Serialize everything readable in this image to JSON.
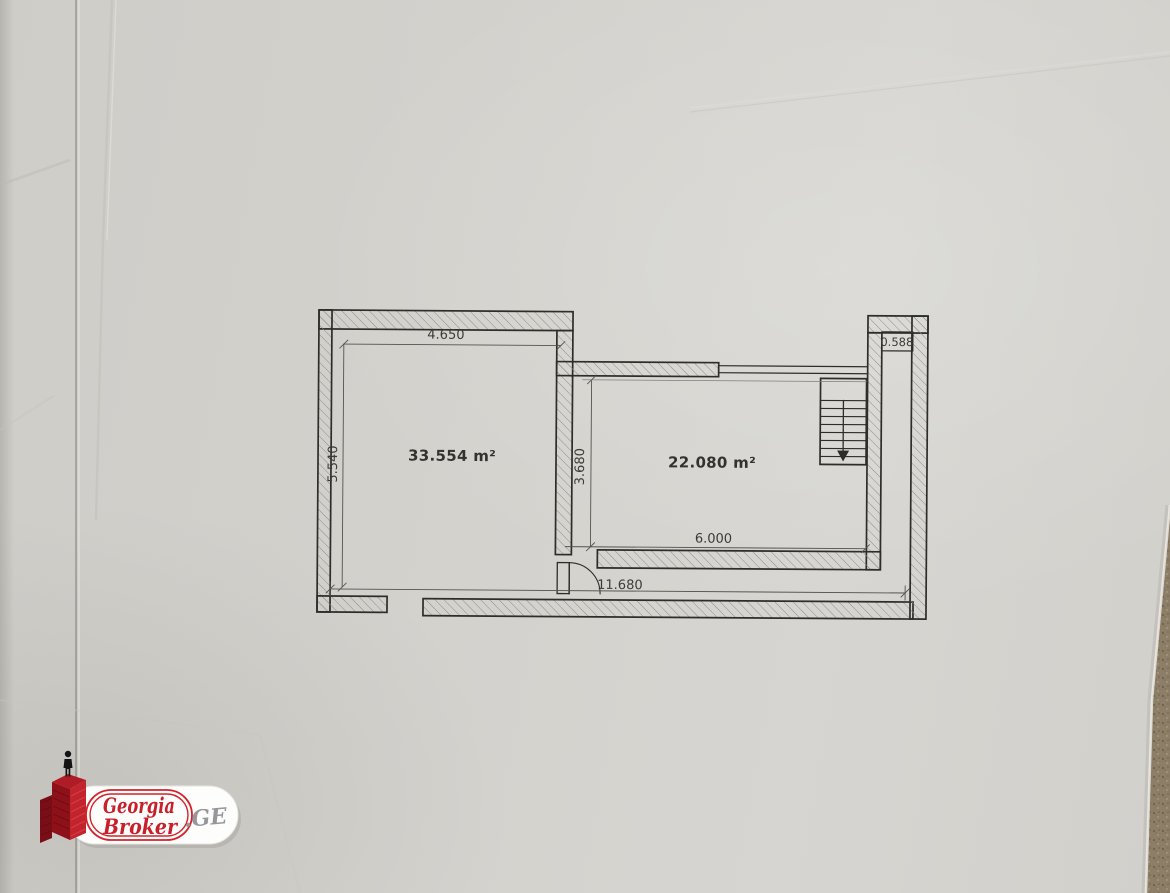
{
  "floor_plan": {
    "rooms": [
      {
        "id": "left-room",
        "area": "33.554 m²"
      },
      {
        "id": "right-room",
        "area": "22.080 m²"
      }
    ],
    "dimensions": {
      "left_room_width_m": "4.650",
      "left_room_height_m": "5.540",
      "partition_height_m": "3.680",
      "right_room_width_m": "6.000",
      "overall_width_m": "11.680",
      "stair_shaft_width_m": "0.588"
    }
  },
  "watermark": {
    "brand_top": "Georgia",
    "brand_bottom": "Broker",
    "suffix": ".GE"
  },
  "colors": {
    "paper": "#d3d1cc",
    "plan_line": "#2e2d29",
    "logo_red": "#c8202b",
    "carpet": "#8d7e67"
  }
}
